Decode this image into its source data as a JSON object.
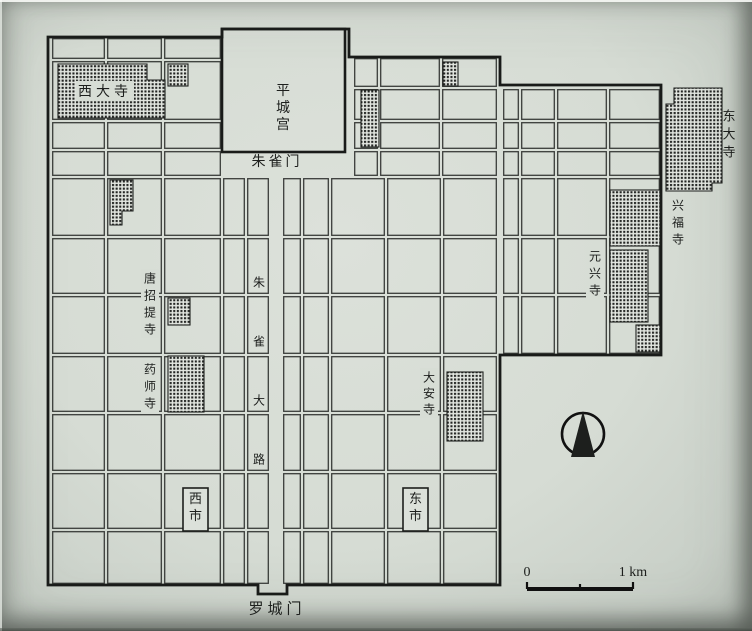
{
  "document": {
    "description_labels": [
      "西大寺",
      "平城宫",
      "朱雀门",
      "东大寺",
      "兴福寺",
      "元兴寺",
      "唐招提寺",
      "药师寺",
      "大安寺",
      "朱雀大路",
      "西市",
      "东市",
      "罗城门"
    ],
    "scale_text": [
      "0",
      "1 km"
    ]
  },
  "colors": {
    "paper": "#d7ddd5",
    "ink": "#1d1f1d",
    "street_line": "#3a3d3a",
    "wall": "#191b19"
  },
  "map": {
    "regions": [
      {
        "name": "west-main",
        "x": [
          51,
          106,
          163,
          222
        ],
        "y": [
          37,
          60,
          121,
          150,
          177,
          237,
          295,
          355,
          413,
          472,
          530,
          585
        ]
      },
      {
        "name": "west-of-avenue",
        "x": [
          222,
          246,
          270
        ],
        "y": [
          177,
          237,
          295,
          355,
          413,
          472,
          530,
          585
        ]
      },
      {
        "name": "east-of-avenue",
        "x": [
          282,
          302,
          330
        ],
        "y": [
          177,
          237,
          295,
          355,
          413,
          472,
          530,
          585
        ]
      },
      {
        "name": "east-top",
        "x": [
          353,
          379,
          441,
          498
        ],
        "y": [
          57,
          88,
          121,
          150,
          177
        ]
      },
      {
        "name": "east-main",
        "x": [
          330,
          386,
          442,
          498
        ],
        "y": [
          177,
          237,
          295,
          355,
          413,
          472,
          530,
          585
        ]
      },
      {
        "name": "outer-capital",
        "x": [
          502,
          520,
          556,
          608,
          661
        ],
        "y": [
          88,
          121,
          150,
          177,
          237,
          295,
          355
        ]
      }
    ],
    "wall_path": "M48,585 L48,37 L222,37 L222,29 L349,29 L349,57 L500,57 L500,85 L661,85 L661,355 L500,355 L500,585 L287,585 L287,594 L258,594 L258,585 Z",
    "palace": {
      "x": 222,
      "y": 29,
      "w": 123,
      "h": 123
    },
    "hatches": [
      {
        "id": "saidaiji-temple-block",
        "points": "58,64 147,64 147,80 165,80 165,118 58,118"
      },
      {
        "id": "temple-block-nw-small",
        "rect": [
          168,
          64,
          20,
          22
        ]
      },
      {
        "id": "temple-block-west-l",
        "points": "110,180 133,180 133,211 122,211 122,225 110,225"
      },
      {
        "id": "temple-strip-palace-east",
        "rect": [
          361,
          90,
          18,
          57
        ]
      },
      {
        "id": "temple-block-north-small",
        "rect": [
          443,
          62,
          15,
          24
        ]
      },
      {
        "id": "todaiji-temple-block",
        "points": "666,104 674,104 674,88 722,88 722,183 712,183 712,191 666,191"
      },
      {
        "id": "kofukuji-temple-block",
        "rect": [
          610,
          190,
          50,
          56
        ]
      },
      {
        "id": "gangoji-temple-block",
        "rect": [
          610,
          250,
          38,
          72
        ]
      },
      {
        "id": "temple-block-se-small",
        "rect": [
          636,
          325,
          24,
          27
        ]
      },
      {
        "id": "toshodaiji-temple-block",
        "rect": [
          168,
          298,
          22,
          27
        ]
      },
      {
        "id": "yakushiji-temple-block",
        "rect": [
          168,
          356,
          36,
          56
        ]
      },
      {
        "id": "daianji-temple-block",
        "rect": [
          447,
          372,
          36,
          69
        ]
      }
    ],
    "labels": [
      {
        "id": "saidaiji-label",
        "text": "西大寺",
        "x": 105,
        "y": 91,
        "dir": "h",
        "size": 14,
        "spacing": 4,
        "chip": true
      },
      {
        "id": "heijo-palace-label",
        "text": "平城宫",
        "x": 283,
        "y": 90,
        "dir": "v",
        "size": 14,
        "gap": 17
      },
      {
        "id": "suzakumon-label",
        "text": "朱雀门",
        "x": 277,
        "y": 161,
        "dir": "h",
        "size": 14,
        "spacing": 3
      },
      {
        "id": "todaiji-label",
        "text": "东大寺",
        "x": 729,
        "y": 116,
        "dir": "v",
        "size": 13,
        "gap": 18
      },
      {
        "id": "kofukuji-label",
        "text": "兴福寺",
        "x": 678,
        "y": 205,
        "dir": "v",
        "size": 12,
        "gap": 17
      },
      {
        "id": "gangoji-label",
        "text": "元兴寺",
        "x": 595,
        "y": 256,
        "dir": "v",
        "size": 12,
        "gap": 17,
        "chip": true
      },
      {
        "id": "toshodaiji-label",
        "text": "唐招提寺",
        "x": 150,
        "y": 278,
        "dir": "v",
        "size": 12,
        "gap": 17,
        "chip": true
      },
      {
        "id": "yakushiji-label",
        "text": "药师寺",
        "x": 150,
        "y": 369,
        "dir": "v",
        "size": 12,
        "gap": 17,
        "chip": true
      },
      {
        "id": "daianji-label",
        "text": "大安寺",
        "x": 429,
        "y": 377,
        "dir": "v",
        "size": 12,
        "gap": 16,
        "chip": true
      },
      {
        "id": "suzaku-avenue-label",
        "text": "朱雀大路",
        "x": 259,
        "y": 282,
        "dir": "v",
        "size": 12,
        "gap": 59
      },
      {
        "id": "rajomon-label",
        "text": "罗城门",
        "x": 277,
        "y": 608,
        "dir": "h",
        "size": 15,
        "spacing": 4
      }
    ],
    "markets": [
      {
        "id": "west-market",
        "label": "西市",
        "x": 183,
        "y": 488,
        "w": 25,
        "h": 43
      },
      {
        "id": "east-market",
        "label": "东市",
        "x": 403,
        "y": 488,
        "w": 25,
        "h": 43
      }
    ],
    "compass": {
      "cx": 583,
      "cy": 434,
      "r": 21
    },
    "scalebar": {
      "x1": 527,
      "x2": 633,
      "y": 589,
      "tick_mid": 580,
      "zero": "0",
      "unit": "1 km"
    }
  }
}
